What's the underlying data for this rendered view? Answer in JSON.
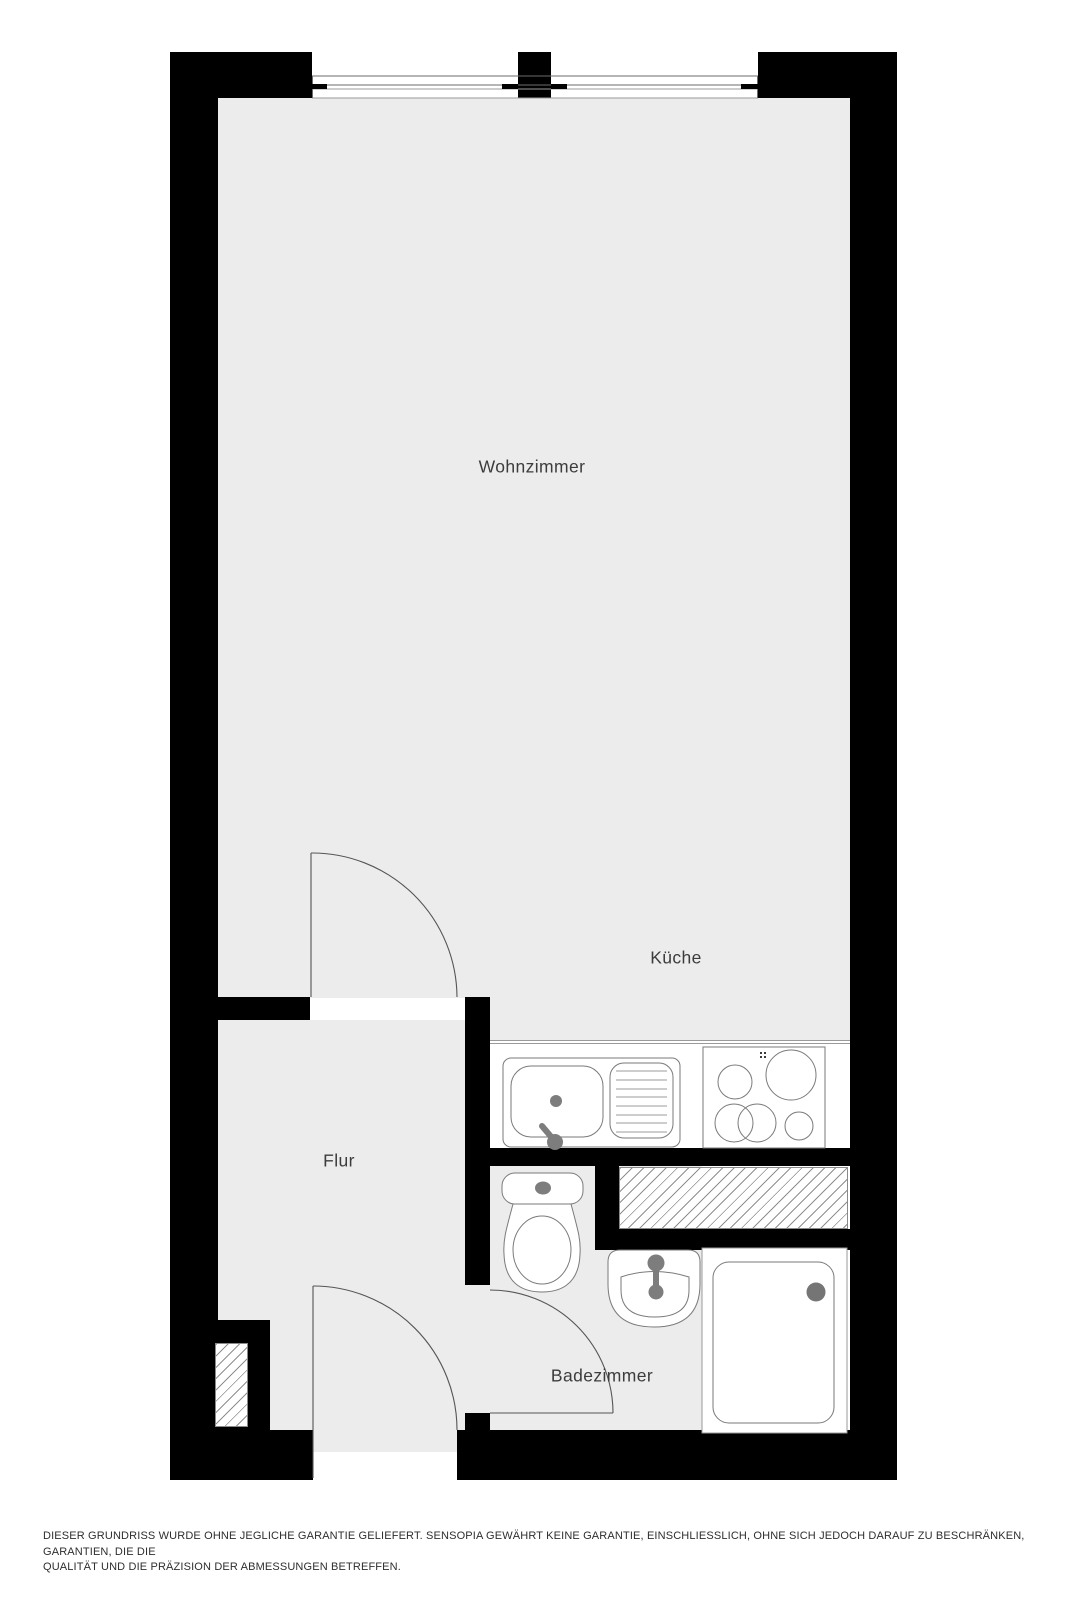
{
  "rooms": {
    "wohnzimmer": "Wohnzimmer",
    "kueche": "Küche",
    "flur": "Flur",
    "badezimmer": "Badezimmer"
  },
  "disclaimer": {
    "line1": "DIESER GRUNDRISS WURDE OHNE JEGLICHE GARANTIE GELIEFERT. SENSOPIA GEWÄHRT KEINE GARANTIE, EINSCHLIESSLICH, OHNE SICH JEDOCH DARAUF ZU BESCHRÄNKEN, GARANTIEN, DIE DIE",
    "line2": "QUALITÄT UND DIE PRÄZISION DER ABMESSUNGEN BETREFFEN."
  },
  "fixtures": [
    "window",
    "window-mullion",
    "interior-door",
    "entrance-door",
    "bathroom-door",
    "kitchen-sink",
    "drainboard",
    "cooktop",
    "toilet",
    "washbasin",
    "shower",
    "ventilation-shaft",
    "ventilation-shaft-small",
    "kitchen-counter"
  ],
  "colors": {
    "wall": "#000000",
    "floor": "#ececec",
    "fixture_fill": "#ffffff",
    "fixture_outline": "#7a7a7a",
    "hardware_gray": "#7d7d7d",
    "label_text": "#3c3c3c",
    "disclaimer_text": "#2e2e2e"
  }
}
